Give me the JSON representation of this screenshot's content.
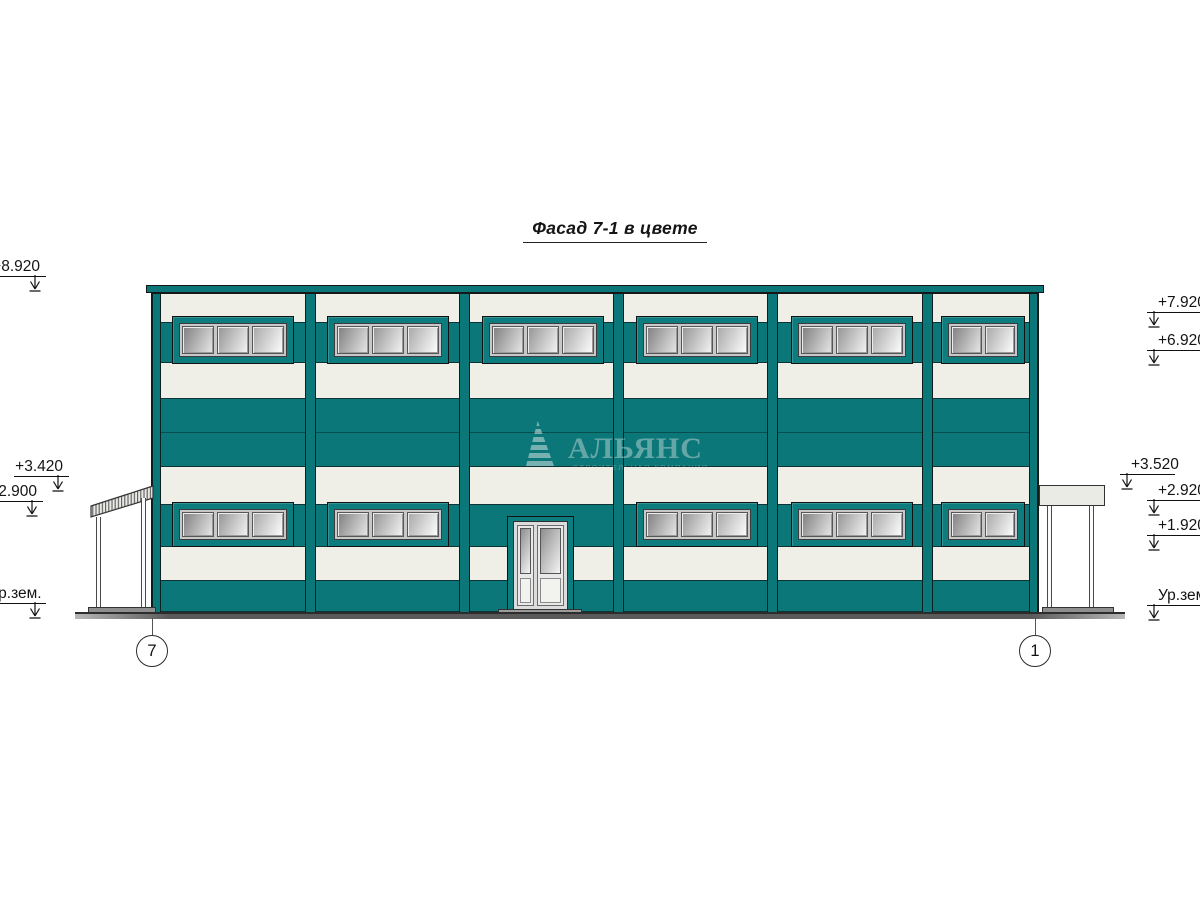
{
  "title": "Фасад 7-1 в цвете",
  "watermark": {
    "brand": "АЛЬЯНС",
    "tagline": "СТРОИТЕЛЬНАЯ КОМПАНИЯ"
  },
  "elevations": {
    "left": [
      {
        "label": "+8.920"
      },
      {
        "label": "+3.420"
      },
      {
        "label": "+2.900"
      },
      {
        "label": "Ур.зем."
      }
    ],
    "right": [
      {
        "label": "+7.920"
      },
      {
        "label": "+6.920"
      },
      {
        "label": "+3.520"
      },
      {
        "label": "+2.920"
      },
      {
        "label": "+1.920"
      },
      {
        "label": "Ур.зем."
      }
    ]
  },
  "axes": [
    {
      "label": "7"
    },
    {
      "label": "1"
    }
  ],
  "colors": {
    "facade_teal": "#0c7779",
    "panel_white": "#efeee7",
    "outline": "#161616",
    "window_frame_gray": "#c8c8c8",
    "ground_gray": "#5a5a5a"
  }
}
